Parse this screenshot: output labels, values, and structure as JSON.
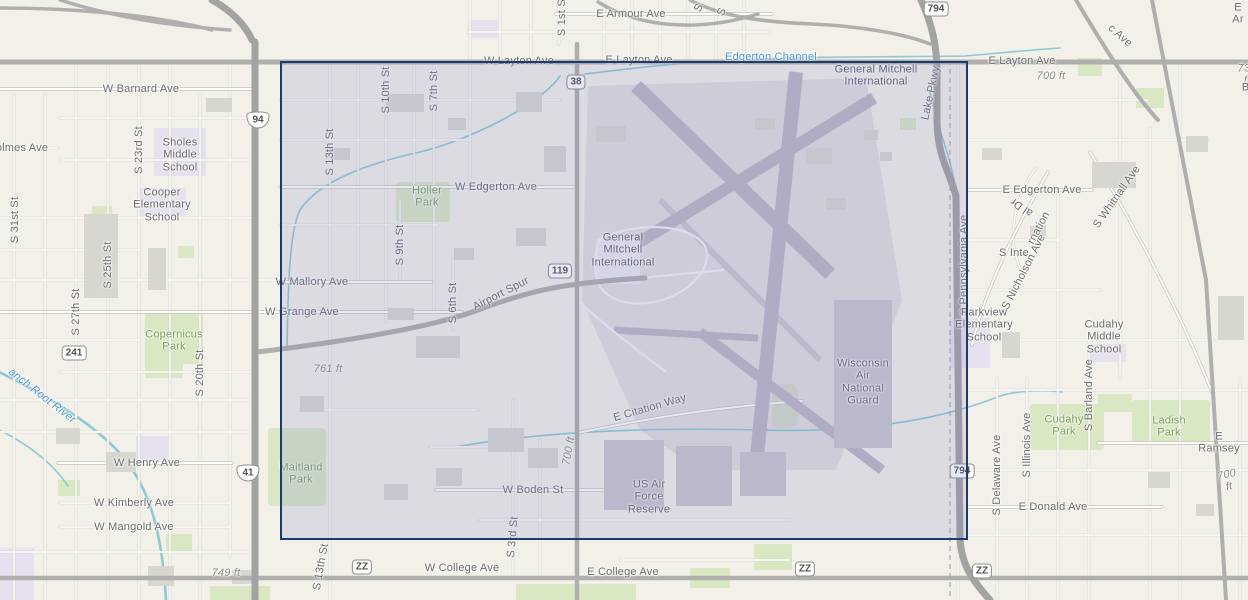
{
  "map": {
    "colors": {
      "selection_border": "#1c3c6e",
      "selection_fill": "rgba(110,118,195,0.17)",
      "park_label": "#74a057",
      "water_label": "#4f97cc",
      "street_label": "#6d6d6d"
    },
    "selection": {
      "x": 280,
      "y": 61,
      "w": 688,
      "h": 479
    },
    "labels": [
      {
        "t": "E Armour Ave",
        "x": 631,
        "y": 14
      },
      {
        "t": "W Layton Ave",
        "x": 519,
        "y": 61
      },
      {
        "t": "E Layton Ave",
        "x": 639,
        "y": 60
      },
      {
        "t": "Edgerton Channel",
        "x": 771,
        "y": 57,
        "c": "wt"
      },
      {
        "t": "General Mitchell\nInternational",
        "x": 876,
        "y": 76,
        "c": "apt"
      },
      {
        "t": "E Layton Ave",
        "x": 1022,
        "y": 61
      },
      {
        "t": "700 ft",
        "x": 1051,
        "y": 76,
        "c": "el"
      },
      {
        "t": "c Ave",
        "x": 1120,
        "y": 36,
        "r": 42
      },
      {
        "t": "E Ar",
        "x": 1238,
        "y": 14
      },
      {
        "t": "730 ft",
        "x": 1247,
        "y": 75,
        "c": "el"
      },
      {
        "t": "E Barnard Ave",
        "x": 1262,
        "y": 88
      },
      {
        "t": "S 1st St",
        "x": 562,
        "y": 16,
        "r": -90
      },
      {
        "t": "S",
        "x": 699,
        "y": 8,
        "r": -65
      },
      {
        "t": "S",
        "x": 722,
        "y": 12,
        "r": -65
      },
      {
        "t": "Lake Pkwy",
        "x": 931,
        "y": 93,
        "r": -78
      },
      {
        "t": "W Barnard Ave",
        "x": 141,
        "y": 89
      },
      {
        "t": "olmes Ave",
        "x": 22,
        "y": 148
      },
      {
        "t": "S 23rd St",
        "x": 139,
        "y": 150,
        "r": -90
      },
      {
        "t": "Sholes\nMiddle\nSchool",
        "x": 180,
        "y": 155,
        "c": "poi"
      },
      {
        "t": "Cooper\nElementary\nSchool",
        "x": 162,
        "y": 205,
        "c": "poi"
      },
      {
        "t": "S 31st St",
        "x": 15,
        "y": 220,
        "r": -90
      },
      {
        "t": "S 27th St",
        "x": 76,
        "y": 312,
        "r": -90
      },
      {
        "t": "S 25th St",
        "x": 108,
        "y": 265,
        "r": -90
      },
      {
        "t": "S 20th St",
        "x": 200,
        "y": 373,
        "r": -90
      },
      {
        "t": "Copernicus\nPark",
        "x": 174,
        "y": 341,
        "c": "pk"
      },
      {
        "t": "anch Root River",
        "x": 42,
        "y": 396,
        "r": 38,
        "c": "wti"
      },
      {
        "t": "W Henry Ave",
        "x": 147,
        "y": 463
      },
      {
        "t": "W Kimberly Ave",
        "x": 134,
        "y": 503
      },
      {
        "t": "W Mangold Ave",
        "x": 134,
        "y": 527
      },
      {
        "t": "749 ft",
        "x": 226,
        "y": 573,
        "c": "el"
      },
      {
        "t": "S 13th St",
        "x": 321,
        "y": 567,
        "r": -80
      },
      {
        "t": "W College Ave",
        "x": 462,
        "y": 568
      },
      {
        "t": "E College Ave",
        "x": 623,
        "y": 572
      },
      {
        "t": "S 13th St",
        "x": 330,
        "y": 152,
        "r": -90
      },
      {
        "t": "S 10th St",
        "x": 386,
        "y": 90,
        "r": -90
      },
      {
        "t": "S 7th St",
        "x": 434,
        "y": 91,
        "r": -90
      },
      {
        "t": "S 9th St",
        "x": 400,
        "y": 245,
        "r": -90
      },
      {
        "t": "Holler\nPark",
        "x": 427,
        "y": 197,
        "c": "pk"
      },
      {
        "t": "W Edgerton Ave",
        "x": 496,
        "y": 187
      },
      {
        "t": "W Mallory Ave",
        "x": 312,
        "y": 282
      },
      {
        "t": "W Grange Ave",
        "x": 302,
        "y": 312
      },
      {
        "t": "Airport Spur",
        "x": 501,
        "y": 294,
        "r": -27
      },
      {
        "t": "S 6th St",
        "x": 453,
        "y": 303,
        "r": -90
      },
      {
        "t": "761 ft",
        "x": 328,
        "y": 369,
        "c": "el"
      },
      {
        "t": "General\nMitchell\nInternational",
        "x": 623,
        "y": 250,
        "c": "apt"
      },
      {
        "t": "Maitland\nPark",
        "x": 301,
        "y": 474,
        "c": "pk"
      },
      {
        "t": "E Citation Way",
        "x": 650,
        "y": 408,
        "r": -16
      },
      {
        "t": "700 ft",
        "x": 569,
        "y": 451,
        "r": -80,
        "c": "el"
      },
      {
        "t": "W Boden St",
        "x": 533,
        "y": 490
      },
      {
        "t": "US Air\nForce\nReserve",
        "x": 649,
        "y": 497,
        "c": "poi"
      },
      {
        "t": "S 3rd St",
        "x": 513,
        "y": 537,
        "r": -85
      },
      {
        "t": "Wisconsin\nAir\nNational\nGuard",
        "x": 863,
        "y": 382,
        "c": "poi"
      },
      {
        "t": "S Pennsylvania Ave",
        "x": 964,
        "y": 265,
        "r": -90
      },
      {
        "t": "E Edgerton Ave",
        "x": 1042,
        "y": 190
      },
      {
        "t": "S Inte",
        "x": 1014,
        "y": 253
      },
      {
        "t": "rnation",
        "x": 1039,
        "y": 228,
        "r": -62
      },
      {
        "t": "al Dr",
        "x": 1022,
        "y": 207,
        "r": -145
      },
      {
        "t": "S Nicholson Ave",
        "x": 1024,
        "y": 272,
        "r": -63
      },
      {
        "t": "S Whitnall Ave",
        "x": 1117,
        "y": 197,
        "r": -55
      },
      {
        "t": "Parkview\nElementary\nSchool",
        "x": 984,
        "y": 325,
        "c": "poi"
      },
      {
        "t": "Cudahy\nMiddle\nSchool",
        "x": 1104,
        "y": 337,
        "c": "poi"
      },
      {
        "t": "Cudahy\nPark",
        "x": 1064,
        "y": 426,
        "c": "pk"
      },
      {
        "t": "S Barland Ave",
        "x": 1089,
        "y": 395,
        "r": -90
      },
      {
        "t": "Ladish\nPark",
        "x": 1169,
        "y": 427,
        "c": "pk"
      },
      {
        "t": "E Ramsey",
        "x": 1219,
        "y": 443
      },
      {
        "t": "700 ft",
        "x": 1228,
        "y": 481,
        "r": -12,
        "c": "el"
      },
      {
        "t": "S Delaware Ave",
        "x": 997,
        "y": 475,
        "r": -90
      },
      {
        "t": "S Illinois Ave",
        "x": 1027,
        "y": 445,
        "r": -90
      },
      {
        "t": "E Donald Ave",
        "x": 1053,
        "y": 507
      }
    ],
    "shields": [
      {
        "t": "794",
        "x": 936,
        "y": 9,
        "c": "sq"
      },
      {
        "t": "38",
        "x": 576,
        "y": 82,
        "c": "sq"
      },
      {
        "t": "119",
        "x": 560,
        "y": 271,
        "c": "sq"
      },
      {
        "t": "241",
        "x": 74,
        "y": 353,
        "c": "sq"
      },
      {
        "t": "794",
        "x": 962,
        "y": 471,
        "c": "sq"
      },
      {
        "t": "ZZ",
        "x": 362,
        "y": 567,
        "c": "sq"
      },
      {
        "t": "ZZ",
        "x": 805,
        "y": 569,
        "c": "sq"
      },
      {
        "t": "ZZ",
        "x": 982,
        "y": 571,
        "c": "sq"
      },
      {
        "t": "94",
        "x": 258,
        "y": 120,
        "c": "int"
      },
      {
        "t": "41",
        "x": 248,
        "y": 473,
        "c": "int"
      }
    ]
  }
}
